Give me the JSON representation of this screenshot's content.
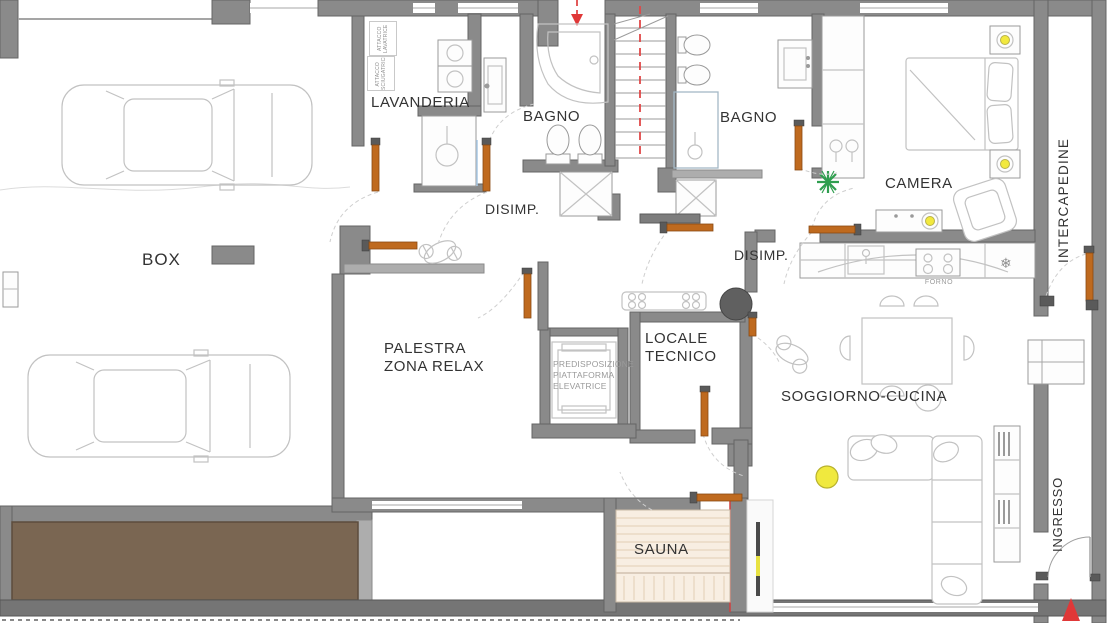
{
  "title_note": "floor plan drawing",
  "colors": {
    "wall_gray": "#8a8a8a",
    "door_orange": "#bf6a1f",
    "accent_red": "#e03838",
    "ramp_brown": "#7a6652",
    "sauna_wood": "#f8eee2",
    "lamp_yellow": "#f2e93e",
    "plant_green": "#2f9e4f"
  },
  "rooms": {
    "box": "BOX",
    "lavanderia": "LAVANDERIA",
    "bagno_1": "BAGNO",
    "bagno_2": "BAGNO",
    "camera": "CAMERA",
    "disimpegno_1": "DISIMP.",
    "disimpegno_2": "DISIMP.",
    "palestra_line_1": "PALESTRA",
    "palestra_line_2": "ZONA RELAX",
    "locale_tecnico_line_1": "LOCALE",
    "locale_tecnico_line_2": "TECNICO",
    "soggiorno_cucina": "SOGGIORNO-CUCINA",
    "sauna": "SAUNA",
    "ingresso": "INGRESSO",
    "intercapedine": "INTERCAPEDINE"
  },
  "annotations": {
    "elevator_note_line_1": "PREDISPOSIZIONE",
    "elevator_note_line_2": "PIATTAFORMA",
    "elevator_note_line_3": "ELEVATRICE",
    "forno": "FORNO",
    "attacco_lavatrice": "ATTACCO LAVATRICE",
    "attacco_asciugatrice": "ATTACCO ASCIUGATRICE"
  },
  "icons": {
    "snowflake_glyph": "❄"
  }
}
